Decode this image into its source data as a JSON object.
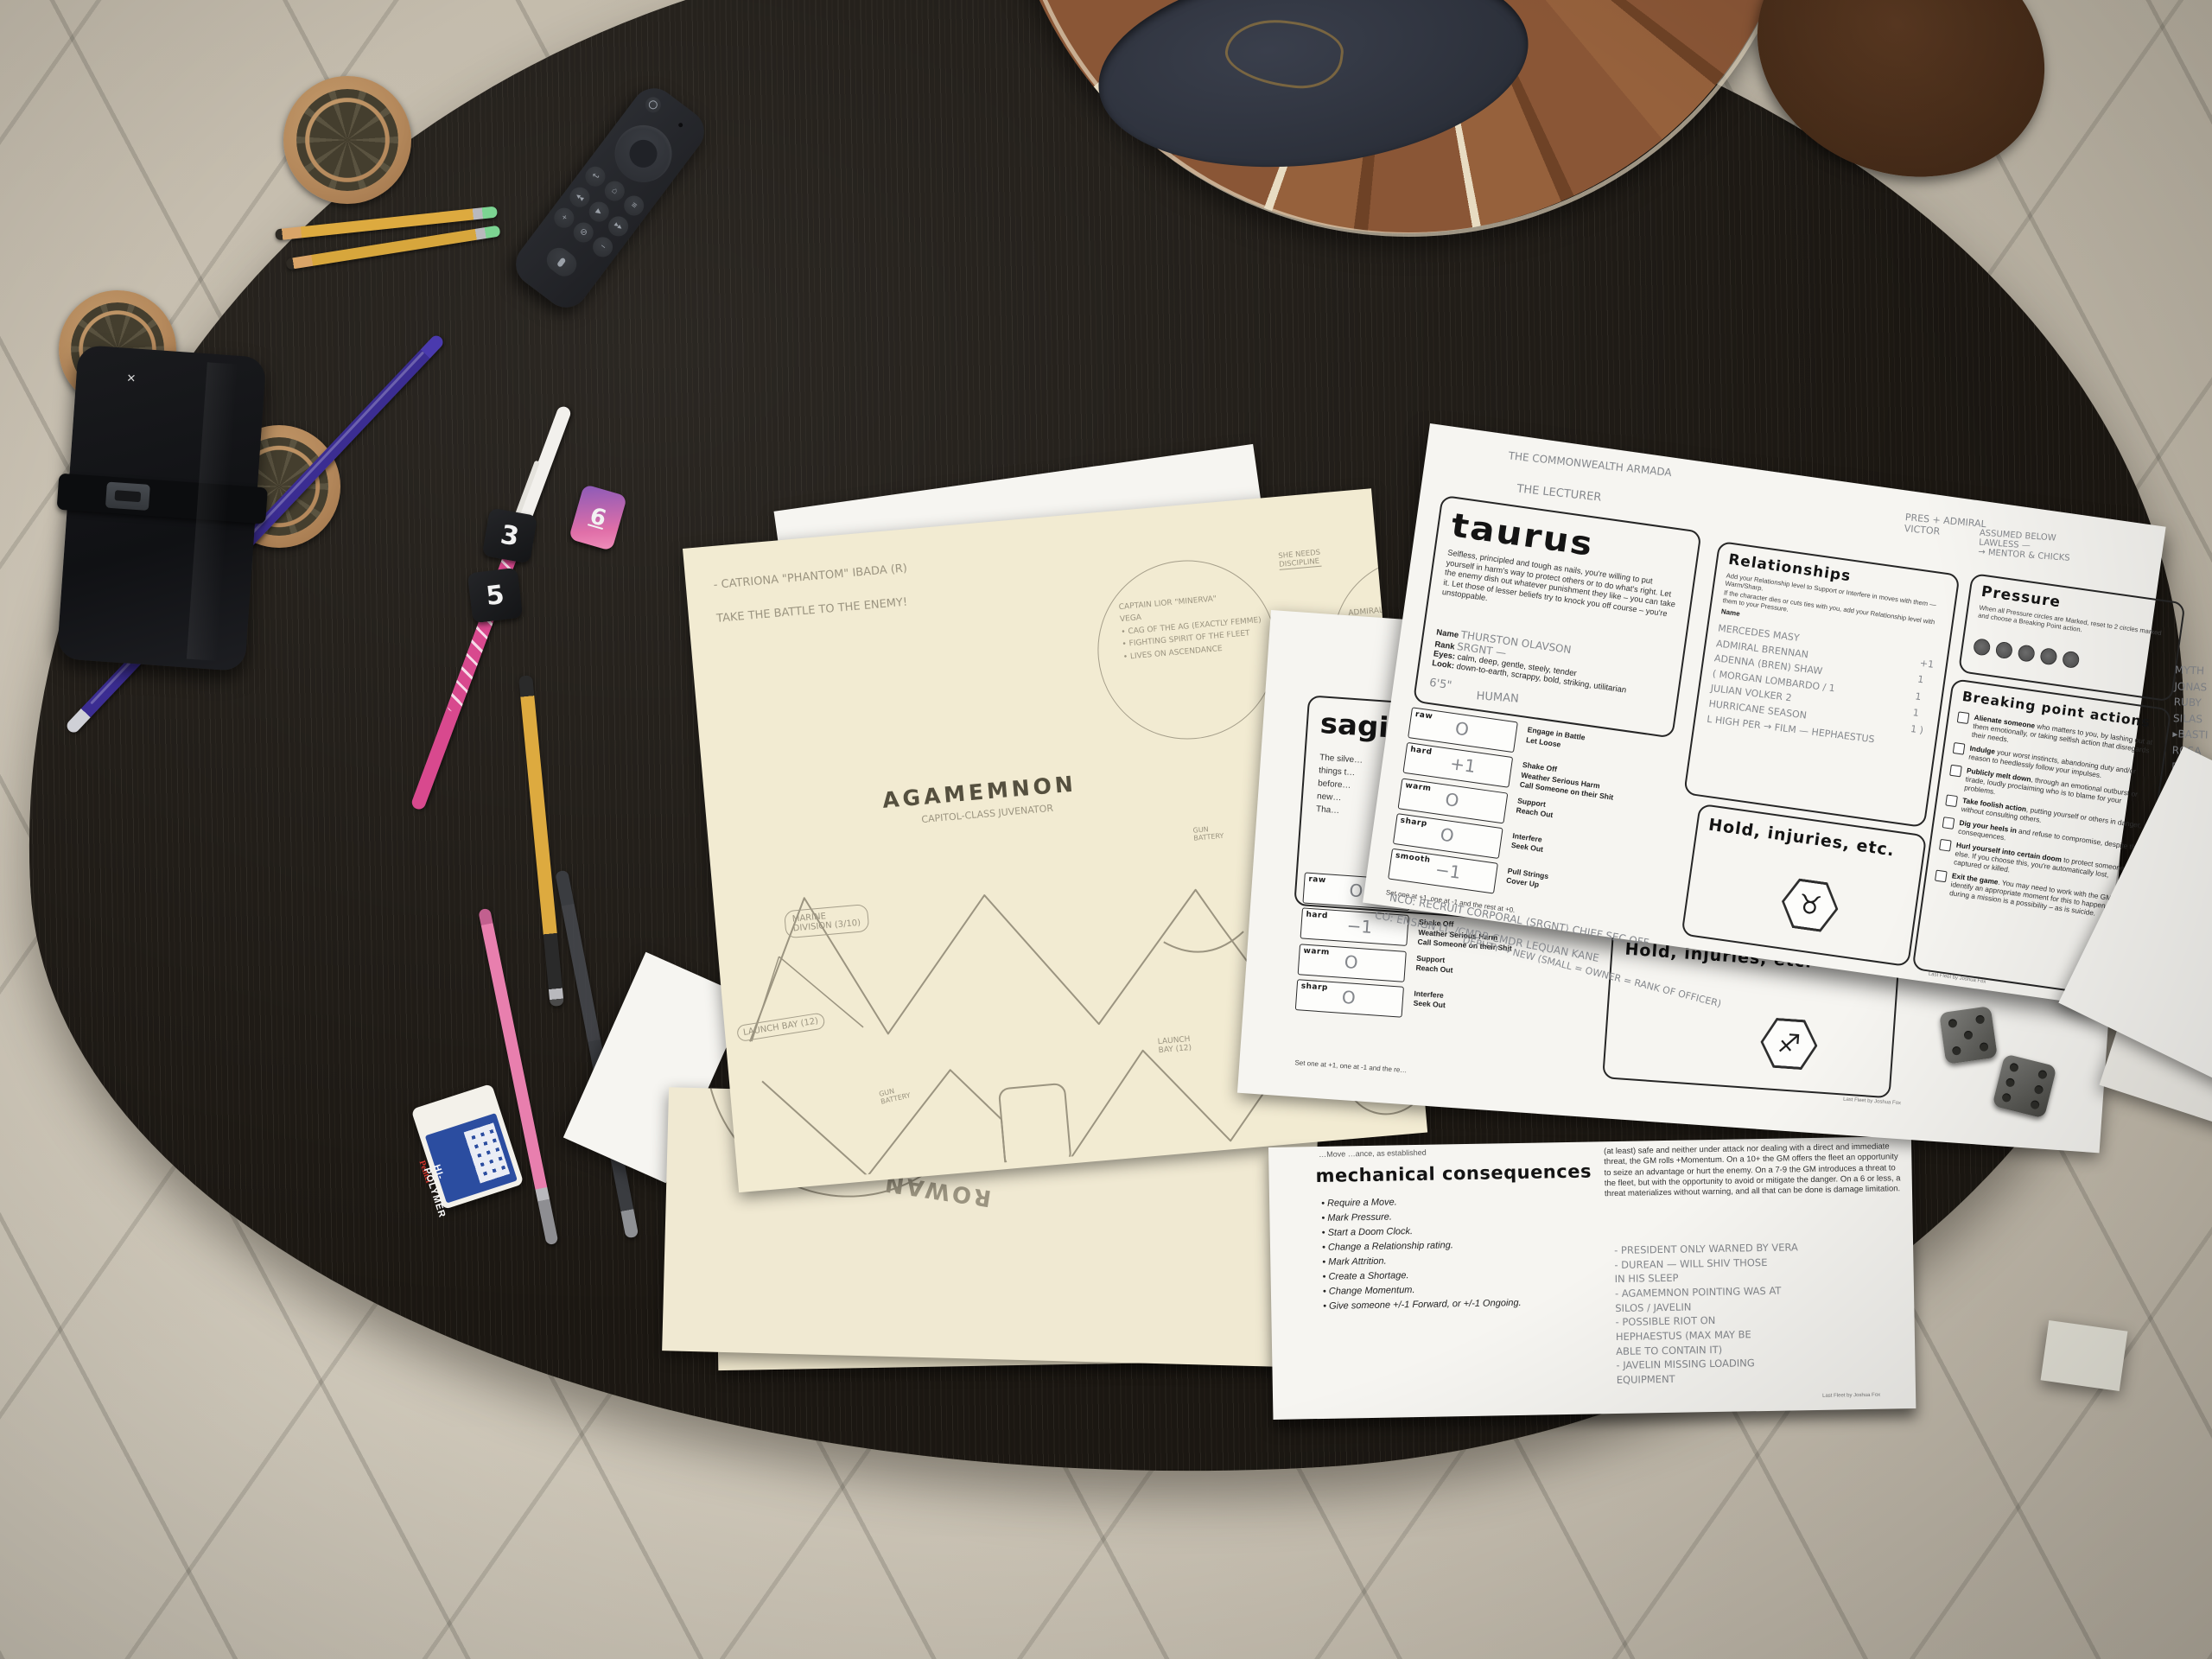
{
  "scene": {
    "setting": "Overhead photo of a tabletop RPG session on a dark oval coffee table over a cream shag rug",
    "game": "Last Fleet"
  },
  "colors": {
    "rug": "#c9c1b2",
    "table": "#1b1712",
    "cream_paper": "#f2ebd2",
    "white_paper": "#f6f5f1",
    "cork": "#b5895c",
    "pencil_gray": "#84878c",
    "pouf_leather": "#8a5636",
    "pouf_top": "#2e323c",
    "remote_body": "#26272c",
    "pen_purple": "#3b2d92",
    "pen_pink": "#d8498e",
    "pencil_yellow": "#ddaa3f",
    "eraser_blue": "#2b4da0",
    "die_pink": "#d06fa8"
  },
  "remote": {
    "name": "streaming media remote",
    "buttons": [
      "power",
      "microphone",
      "nav-ring",
      "select",
      "back",
      "home",
      "menu",
      "rewind",
      "play-pause",
      "fast-forward",
      "volume-up",
      "mute",
      "volume-down",
      "voice"
    ],
    "glyphs": {
      "back": "↩",
      "home": "⌂",
      "menu": "≡",
      "rewind": "◀◀",
      "play": "▶",
      "ff": "▶▶",
      "vol_up": "+",
      "mute": "⊘",
      "vol_down": "−"
    }
  },
  "eraser": {
    "brand": "Pentel",
    "label": "HI-POLYMER"
  },
  "dice": {
    "black_values": [
      "3",
      "5"
    ],
    "pink_value": "6",
    "metal_pip_values": [
      5,
      6
    ]
  },
  "sheet_peek": {
    "fragment": "Res"
  },
  "agamemnon": {
    "note_line1": "- CATRIONA \"PHANTOM\" IBADA (R)",
    "note_line2": "TAKE THE BATTLE TO THE ENEMY!",
    "captain_circle": "CAPTAIN LIOR \"MINERVA\"\nVEGA\n• CAG OF THE AG (EXACTLY FEMME)\n• FIGHTING SPIRIT OF THE FLEET\n• LIVES ON ASCENDANCE",
    "arrow_note1": "SHE NEEDS\nDISCIPLINE",
    "arrow_note2": "CHECK UP\nHER SHIT",
    "admiral_circle": "ADMIRAL B…\n• HEATED, MARRIED…\n• HOLDS…",
    "title": "AGAMEMNON",
    "subtitle": "CAPITOL-CLASS JUVENATOR",
    "label_marine": "MARINE\nDIVISION (3/10)",
    "label_launch_left": "LAUNCH BAY (12)",
    "label_gun_top": "GUN\nBATTERY",
    "label_gun_bottom": "GUN\nBATTERY",
    "label_launch_mid": "LAUNCH\nBAY (12)"
  },
  "rowan": {
    "name": "ROWAN"
  },
  "taurus": {
    "hw_header1": "THE COMMONWEALTH ARMADA",
    "hw_header2": "THE LECTURER",
    "hw_topright": "PRES + ADMIRAL\nVICTOR",
    "title": "taurus",
    "description": "Selfless, principled and tough as nails, you're willing to put yourself in harm's way to protect others or to do what's right. Let the enemy dish out whatever punishment they like – you can take it. Let those of lesser beliefs try to knock you off course – you're unstoppable.",
    "name_label": "Name",
    "rank_label": "Rank",
    "eyes_label": "Eyes:",
    "look_label": "Look:",
    "name_value": "THURSTON OLAVSON",
    "rank_value": "SRGNT —",
    "eyes_value": "calm, deep, gentle, steely, tender",
    "look_value": "down-to-earth, scrappy, bold, striking, utilitarian",
    "hw_height": "6'5\"",
    "hw_species": "HUMAN",
    "stats": [
      {
        "label": "raw",
        "value": "O",
        "moves": "Engage in Battle\nLet Loose"
      },
      {
        "label": "hard",
        "value": "+1",
        "moves": "Shake Off\nWeather Serious Harm\nCall Someone on their Shit"
      },
      {
        "label": "warm",
        "value": "O",
        "moves": "Support\nReach Out"
      },
      {
        "label": "sharp",
        "value": "O",
        "moves": "Interfere\nSeek Out"
      },
      {
        "label": "smooth",
        "value": "−1",
        "moves": "Pull Strings\nCover Up"
      }
    ],
    "stats_note": "Set one at +1, one at -1 and the rest at +0.",
    "relationships": {
      "title": "Relationships",
      "note1": "Add your Relationship level to Support or Interfere in moves with them — Warm/Sharp.",
      "note2": "If the character dies or cuts ties with you, add your Relationship level with them to your Pressure.",
      "name_col": "Name",
      "entries": "MERCEDES MASY\nADMIRAL BRENNAN\nADENNA (BREN) SHAW\n( MORGAN LOMBARDO / 1\nJULIAN VOLKER 2\nHURRICANE SEASON\nL HIGH PER → FILM — HEPHAESTUS",
      "values": "+1\n1\n1\n1\n1 )"
    },
    "pressure": {
      "title": "Pressure",
      "note": "When all Pressure circles are Marked, reset to 2 circles marked and choose a Breaking Point action.",
      "hw_above": "ASSUMED BELOW\nLAWLESS —\n→ MENTOR & CHICKS"
    },
    "breaking": {
      "title": "Breaking point actions",
      "items": [
        {
          "b": "Alienate someone",
          "t": " who matters to you, by lashing out at them emotionally, or taking selfish action that disregards their needs."
        },
        {
          "b": "Indulge",
          "t": " your worst instincts, abandoning duty and/or reason to heedlessly follow your impulses."
        },
        {
          "b": "Publicly melt down",
          "t": ", through an emotional outburst or tirade, loudly proclaiming who is to blame for your problems."
        },
        {
          "b": "Take foolish action",
          "t": ", putting yourself or others in danger, without consulting others."
        },
        {
          "b": "Dig your heels in",
          "t": " and refuse to compromise, despite the consequences."
        },
        {
          "b": "Hurl yourself into certain doom",
          "t": " to protect someone else. If you choose this, you're automatically lost, captured or killed."
        },
        {
          "b": "Exit the game",
          "t": ". You may need to work with the GM to identify an appropriate moment for this to happen. Death during a mission is a possibility – as is suicide."
        }
      ]
    },
    "hold_title": "Hold, injuries, etc.",
    "zodiac_symbol": "♉",
    "margin_names": "MYTH\nJONAS\nRUBY\nSILAS\n▸BASTI\nROSA\nDOROTHY\n(DOT)",
    "hw_bottom1": "NCO:  RECRUIT    CORPORAL    ⟨SRGNT⟩    CHIEF      SEC OFF",
    "hw_bottom2": "CO:  ENSIGN    LT. /CMDR    CMDR    LEQUAN KANE",
    "hw_bottom3": "DEPUTY → NEW (SMALL = OWNER = RANK OF OFFICER)",
    "credit": "Last Fleet by Joshua Fox"
  },
  "sagittarius": {
    "title": "sagittarius",
    "desc_fragment": "The silve…\nthings t…\nbefore…\nnew…\nTha…",
    "hw_notes": "N: NEMO\nBLACK\nMOULD\n+1 J8\nJAVELIN",
    "stats": [
      {
        "label": "raw",
        "value": "O"
      },
      {
        "label": "hard",
        "value": "−1"
      },
      {
        "label": "warm",
        "value": "O"
      },
      {
        "label": "sharp",
        "value": "O"
      }
    ],
    "moves2": "Shake Off\nWeather Serious Harm\nCall Someone on their Shit",
    "moves3": "Support\nReach Out",
    "moves4": "Interfere\nSeek Out",
    "stats_note": "Set one at +1, one at -1 and the re…",
    "hold_title": "Hold, injuries, etc.",
    "zodiac_symbol": "♐",
    "credit": "Last Fleet by Joshua Fox"
  },
  "consequences": {
    "header_fragment": "…Move                                   …ance, as established",
    "title": "mechanical consequences",
    "items": "• Require a Move.\n• Mark Pressure.\n• Start a Doom Clock.\n• Change a Relationship rating.\n• Mark Attrition.\n• Create a Shortage.\n• Change Momentum.\n• Give someone +/-1 Forward, or +/-1 Ongoing.",
    "right_paragraph": "(at least) safe and neither under attack nor dealing with a direct and immediate threat, the GM rolls +Momentum. On a 10+ the GM offers the fleet an opportunity to seize an advantage or hurt the enemy. On a 7-9 the GM introduces a threat to the fleet, but with the opportunity to avoid or mitigate the danger. On a 6 or less, a threat materializes without warning, and all that can be done is damage limitation.",
    "hw_notes": "- PRESIDENT ONLY WARNED BY VERA\n- DUREAN — WILL SHIV THOSE\nIN HIS SLEEP\n- AGAMEMNON POINTING WAS AT\nSILOS / JAVELIN\n- POSSIBLE RIOT ON\nHEPHAESTUS (MAX MAY BE\nABLE TO CONTAIN IT)\n- JAVELIN MISSING LOADING\nEQUIPMENT",
    "credit": "Last Fleet by Joshua Fox"
  }
}
